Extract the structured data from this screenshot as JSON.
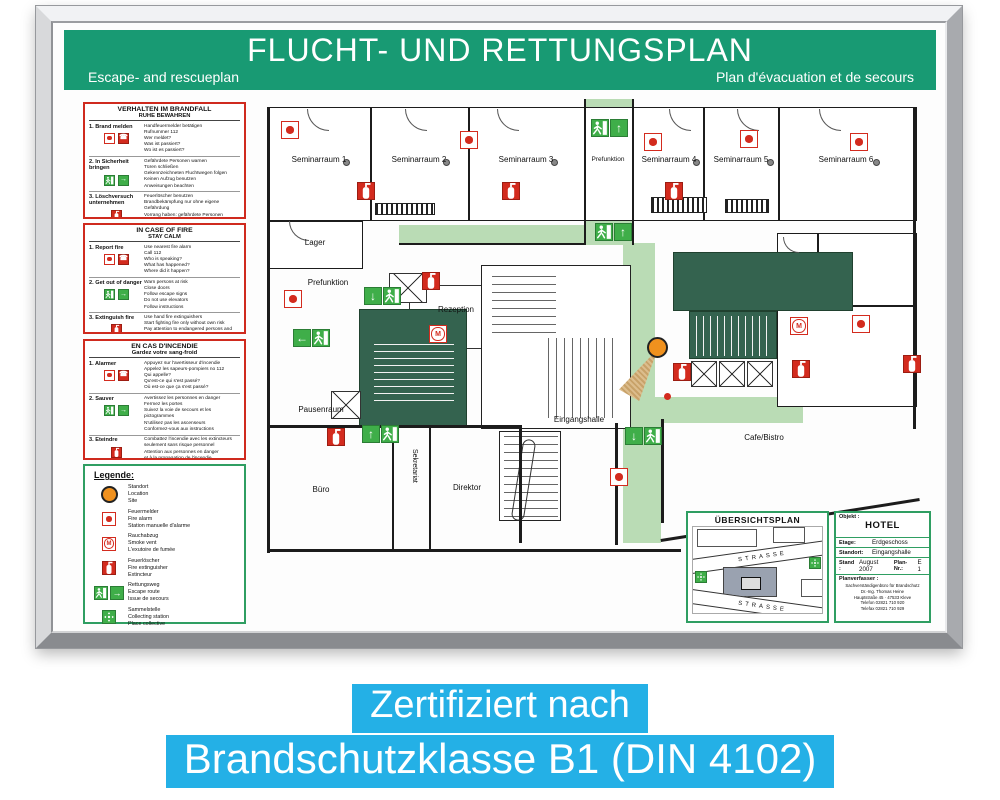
{
  "header": {
    "title": "FLUCHT- UND RETTUNGSPLAN",
    "subtitle_left": "Escape- and rescueplan",
    "subtitle_right": "Plan d'évacuation et de secours"
  },
  "instructions": [
    {
      "title": "VERHALTEN IM BRANDFALL",
      "subtitle": "RUHE BEWAHREN",
      "steps": [
        {
          "label": "1. Brand melden",
          "text": "Handfeuermelder betätigen\nRufnummer 112\nWer meldet?\nWas ist passiert?\nWo ist es passiert?"
        },
        {
          "label": "2. In Sicherheit bringen",
          "text": "Gefährdete Personen warnen\nTüren schließen\nGekennzeichneten Fluchtwegen folgen\nKeinen Aufzug benutzen\nAnweisungen beachten"
        },
        {
          "label": "3. Löschversuch unternehmen",
          "text": "Feuerlöscher benutzen\nBrandbekämpfung nur ohne eigene Gefährdung\nVorrang haben: gefährdete Personen\nLage des Brandherds"
        }
      ]
    },
    {
      "title": "IN CASE OF FIRE",
      "subtitle": "STAY CALM",
      "steps": [
        {
          "label": "1. Report fire",
          "text": "Use nearest fire alarm\nCall 112\nWho is speaking?\nWhat has happened?\nWhere did it happen?"
        },
        {
          "label": "2. Get out of danger",
          "text": "Warn persons at risk\nClose doors\nFollow escape signs\nDo not use elevators\nFollow instructions"
        },
        {
          "label": "3. Extinguish fire",
          "text": "Use hand fire extinguishers\nStart fighting fire only without own risk\nPay attention to endangered persons and\nspread of fire"
        }
      ]
    },
    {
      "title": "EN CAS D'INCENDIE",
      "subtitle": "Gardez votre sang-froid",
      "steps": [
        {
          "label": "1. Alarmer",
          "text": "Appuyez sur l'avertisseur d'incendie\nAppelez les sapeurs-pompiers no 112\nQui appelle?\nQu'est-ce qui s'est passé?\nOù est-ce que ça s'est passé?"
        },
        {
          "label": "2. Sauver",
          "text": "Avertissez les personnes en danger\nFermez les portes\nSuivez la voie de secours et les pictogrammes\nN'utilisez pas les ascenseurs\nConformez-vous aux instructions"
        },
        {
          "label": "3. Eteindre",
          "text": "Combattez l'incendie avec les extincteurs\nseulement sans risque personnel\nAttention aux personnes en danger\net à la propagation de l'incendie\net au foyer d'incendie"
        }
      ]
    }
  ],
  "legend": {
    "title": "Legende:",
    "items": [
      {
        "icon": "location",
        "text": "Standort\nLocation\nSite"
      },
      {
        "icon": "fire-alarm",
        "text": "Feuermelder\nFire alarm\nStation manuelle d'alarme"
      },
      {
        "icon": "smoke-vent",
        "text": "Rauchabzug\nSmoke vent\nL'exutoire de fumée"
      },
      {
        "icon": "fire-extinguisher",
        "text": "Feuerlöscher\nFire extinguisher\nExtincteur"
      },
      {
        "icon": "escape-route",
        "text": "Rettungsweg\nEscape route\nIssue de secours"
      },
      {
        "icon": "assembly-point",
        "text": "Sammelstelle\nCollecting station\nPlace collective"
      }
    ]
  },
  "floorplan": {
    "rooms": {
      "seminar1": "Seminarraum 1",
      "seminar2": "Seminarraum 2",
      "seminar3": "Seminarraum 3",
      "seminar4": "Seminarraum 4",
      "seminar5": "Seminarraum 5",
      "seminar6": "Seminarraum 6",
      "prefunktion_top": "Prefunktion",
      "lager": "Lager",
      "prefunktion_left": "Prefunktion",
      "rezeption": "Rezeption",
      "pausenraum": "Pausenraum",
      "buero": "Büro",
      "sekretariat": "Sekretariat",
      "direktor": "Direktor",
      "eingangshalle": "Eingangshalle",
      "cafe": "Cafe/Bistro"
    }
  },
  "titleblock": {
    "overview_title": "ÜBERSICHTSPLAN",
    "street_top": "STRASSE",
    "street_bottom": "STRASSE",
    "objekt_label": "Objekt :",
    "objekt_value": "HOTEL",
    "etage_label": "Etage:",
    "etage_value": "Erdgeschoss",
    "standort_label": "Standort:",
    "standort_value": "Eingangshalle",
    "stand_label": "Stand :",
    "stand_value": "August 2007",
    "plan_nr_label": "Plan-Nr.:",
    "plan_nr_value": "E 1",
    "planverfasser_label": "Planverfasser :",
    "planverfasser_text": "Sachverständigenbüro für Brandschutz\nDr.-Ing. Thomas Heine\nHauptstraße 45 · 47533 Kleve\nTelefon 02821 710 920\nTelefax 02821 710 929"
  },
  "banner": {
    "line1": "Zertifiziert nach",
    "line2": "Brandschutzklasse B1 (DIN 4102)"
  },
  "glyphs": {
    "up": "↑",
    "down": "↓",
    "left": "←",
    "right": "→",
    "phone": "☎",
    "m": "M"
  },
  "colors": {
    "header_green": "#189a73",
    "legend_green": "#2f9e62",
    "signal_red": "#d32b1e",
    "route_green": "#badcb5",
    "exit_green": "#3fae49",
    "stair_green": "#34634f",
    "location_orange": "#f0911e",
    "banner_cyan": "#24b0e6"
  }
}
